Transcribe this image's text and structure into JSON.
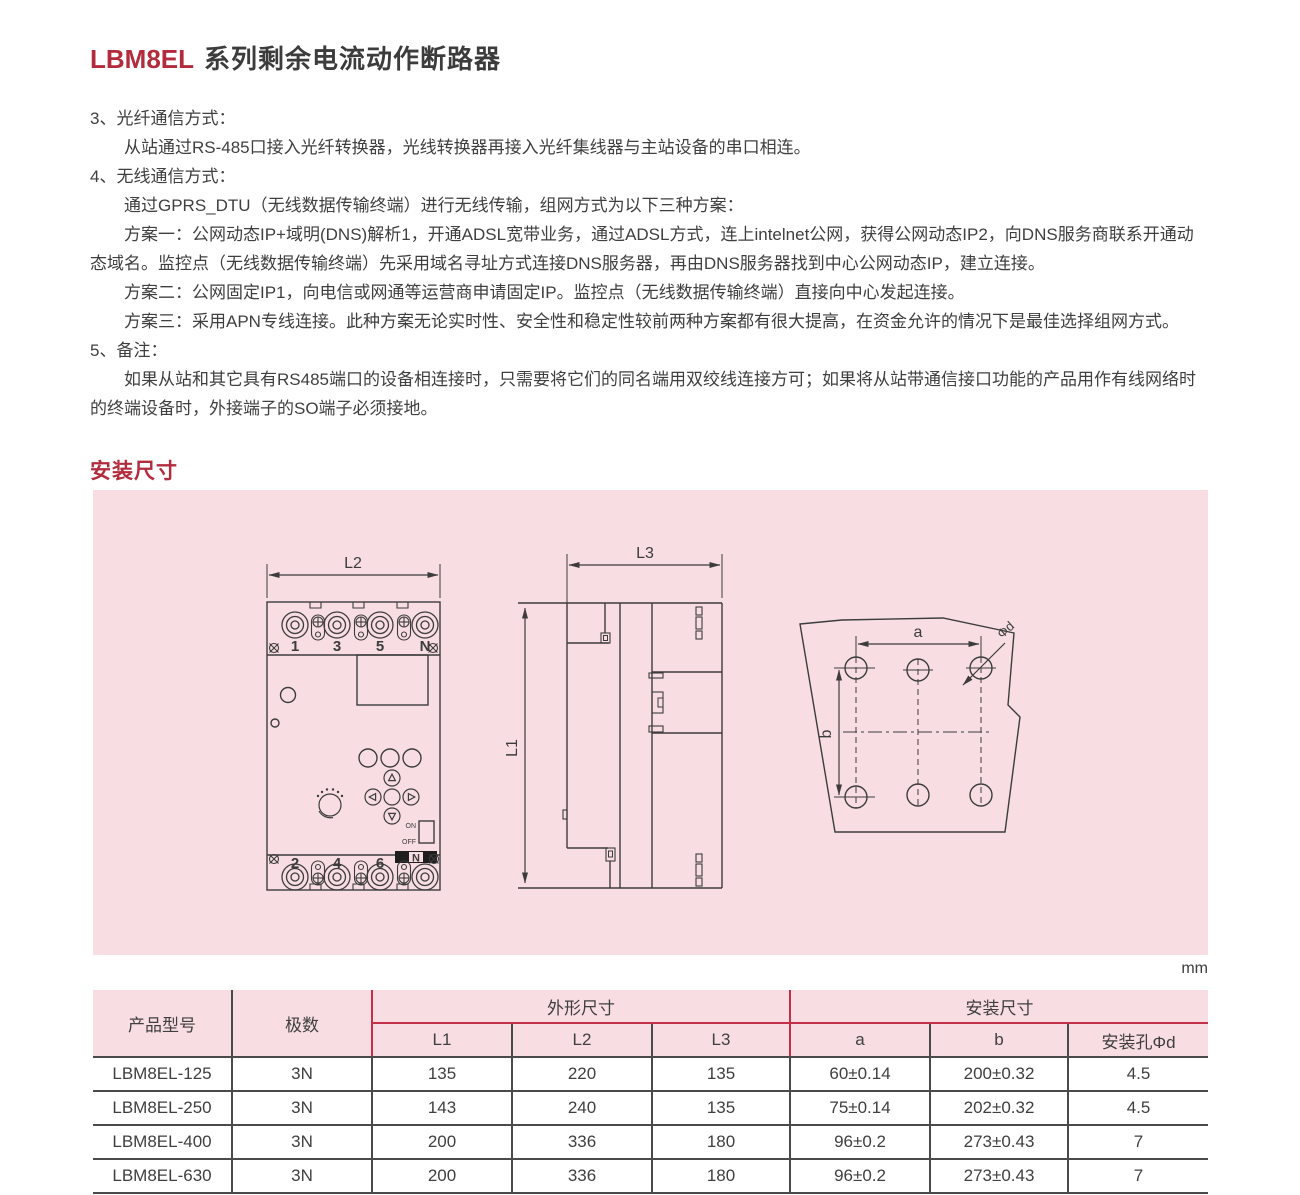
{
  "title": {
    "code": "LBM8EL",
    "rest": "系列剩余电流动作断路器"
  },
  "section_heading": "安装尺寸",
  "unit_label": "mm",
  "notes": [
    {
      "text": "3、光纤通信方式："
    },
    {
      "text": "从站通过RS-485口接入光纤转换器，光线转换器再接入光纤集线器与主站设备的串口相连。"
    },
    {
      "text": "4、无线通信方式："
    },
    {
      "text": "通过GPRS_DTU（无线数据传输终端）进行无线传输，组网方式为以下三种方案："
    },
    {
      "text": "方案一：公网动态IP+域明(DNS)解析1，开通ADSL宽带业务，通过ADSL方式，连上intelnet公网，获得公网动态IP2，向DNS服务商联系开通动态域名。监控点（无线数据传输终端）先采用域名寻址方式连接DNS服务器，再由DNS服务器找到中心公网动态IP，建立连接。"
    },
    {
      "text": "方案二：公网固定IP1，向电信或网通等运营商申请固定IP。监控点（无线数据传输终端）直接向中心发起连接。"
    },
    {
      "text": "方案三：采用APN专线连接。此种方案无论实时性、安全性和稳定性较前两种方案都有很大提高，在资金允许的情况下是最佳选择组网方式。"
    },
    {
      "text": "5、备注："
    },
    {
      "text": "如果从站和其它具有RS485端口的设备相连接时，只需要将它们的同名端用双绞线连接方可；如果将从站带通信接口功能的产品用作有线网络时的终端设备时，外接端子的SO端子必须接地。"
    }
  ],
  "diagram": {
    "front_view": {
      "dim_l2": "L2",
      "top_terminals": [
        "1",
        "3",
        "5",
        "N"
      ],
      "bottom_terminals": [
        "2",
        "4",
        "6",
        "N"
      ],
      "switch_on": "ON",
      "switch_off": "OFF"
    },
    "side_view": {
      "dim_l3": "L3",
      "dim_l1": "L1"
    },
    "hole_view": {
      "dim_a": "a",
      "dim_b": "b",
      "dim_d": "Φd"
    }
  },
  "table": {
    "col_product": "产品型号",
    "col_poles": "极数",
    "group_outline": "外形尺寸",
    "group_install": "安装尺寸",
    "sub_cols": [
      "L1",
      "L2",
      "L3",
      "a",
      "b",
      "安装孔Φd"
    ],
    "rows": [
      {
        "model": "LBM8EL-125",
        "poles": "3N",
        "l1": "135",
        "l2": "220",
        "l3": "135",
        "a": "60±0.14",
        "b": "200±0.32",
        "d": "4.5"
      },
      {
        "model": "LBM8EL-250",
        "poles": "3N",
        "l1": "143",
        "l2": "240",
        "l3": "135",
        "a": "75±0.14",
        "b": "202±0.32",
        "d": "4.5"
      },
      {
        "model": "LBM8EL-400",
        "poles": "3N",
        "l1": "200",
        "l2": "336",
        "l3": "180",
        "a": "96±0.2",
        "b": "273±0.43",
        "d": "7"
      },
      {
        "model": "LBM8EL-630",
        "poles": "3N",
        "l1": "200",
        "l2": "336",
        "l3": "180",
        "a": "96±0.2",
        "b": "273±0.43",
        "d": "7"
      }
    ]
  },
  "colors": {
    "accent_red": "#b22c3d",
    "panel_pink": "#f8dee2",
    "table_line_red": "#c23049",
    "drawing_line": "#3c3c3c",
    "border_dark": "#4a4a4a"
  }
}
